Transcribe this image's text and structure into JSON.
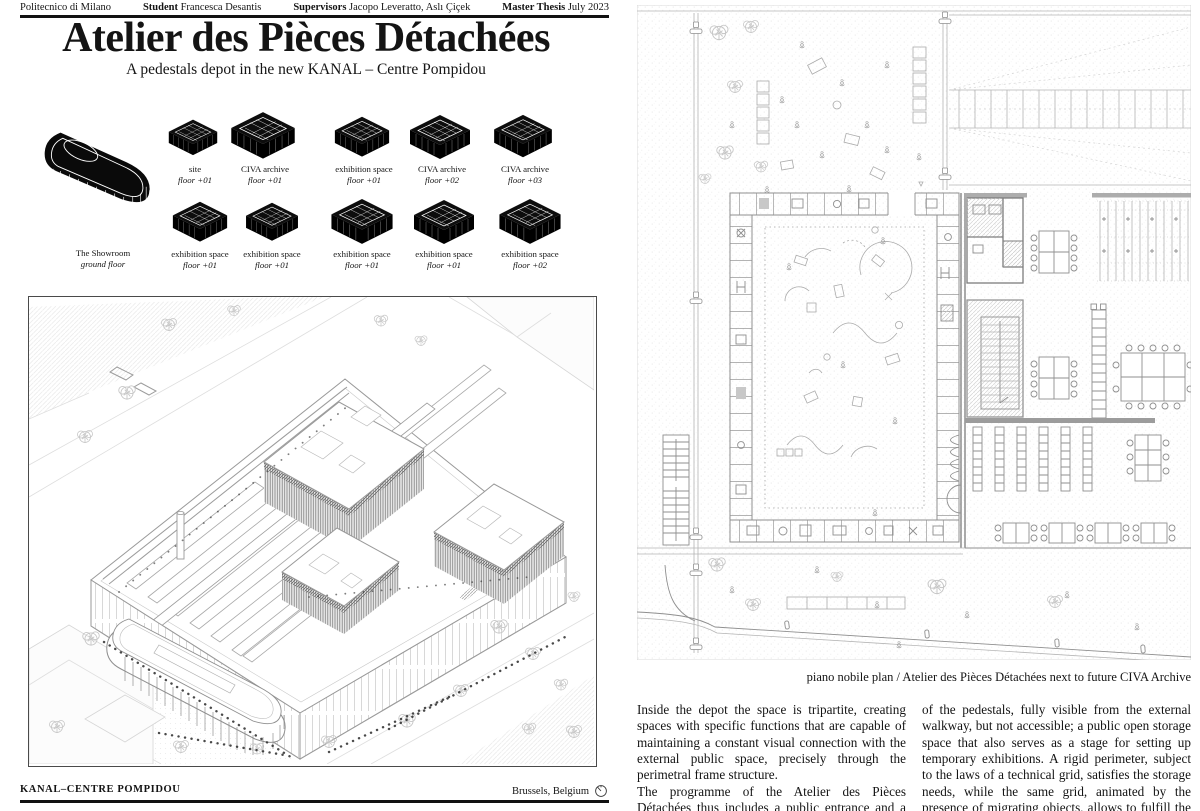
{
  "header": {
    "institution": "Politecnico di Milano",
    "student_label": "Student",
    "student_name": "Francesca Desantis",
    "supervisors_label": "Supervisors",
    "supervisors_names": "Jacopo Leveratto, Aslı Çiçek",
    "thesis_label": "Master Thesis",
    "thesis_date": "July 2023"
  },
  "masthead": {
    "title": "Atelier des Pièces Détachées",
    "subtitle": "A pedestals depot in the new KANAL – Centre Pompidou"
  },
  "diagrams": {
    "showroom": {
      "name": "The Showroom",
      "floor": "ground floor"
    },
    "row1": [
      {
        "name": "site",
        "floor": "floor +01"
      },
      {
        "name": "CIVA archive",
        "floor": "floor +01"
      },
      {
        "name": "exhibition space",
        "floor": "floor +01"
      },
      {
        "name": "CIVA archive",
        "floor": "floor +02"
      },
      {
        "name": "CIVA archive",
        "floor": "floor +03"
      }
    ],
    "row2": [
      {
        "name": "exhibition space",
        "floor": "floor +01"
      },
      {
        "name": "exhibition space",
        "floor": "floor +01"
      },
      {
        "name": "exhibition space",
        "floor": "floor +01"
      },
      {
        "name": "exhibition space",
        "floor": "floor +01"
      },
      {
        "name": "exhibition space",
        "floor": "floor +02"
      }
    ]
  },
  "plan": {
    "caption": "piano nobile plan / Atelier des Pièces Détachées next to future CIVA Archive"
  },
  "body": {
    "col1_p1": "Inside the depot the space is tripartite, creating spaces with specific functions that are capable of maintaining a constant visual connection with the external public space, precisely through the perimetral frame structure.",
    "col1_p2": "The programme of the Atelier des Pièces Détachées thus includes a public entrance and a bookshop space; a workshop space intended for the study and digital archiving",
    "col2_p1": "of the pedestals, fully visible from the external walkway, but not accessible; a public open storage space that also serves as a stage for setting up temporary exhibitions. A rigid perimeter, subject to the laws of a technical grid, satisfies the storage needs, while the same grid, animated by the presence of migrating objects, allows to fulfill the needs for flexibility of the central stage."
  },
  "footer": {
    "project": "KANAL–CENTRE POMPIDOU",
    "location": "Brussels, Belgium"
  },
  "colors": {
    "ink": "#141414",
    "line_light": "#c3c3c3",
    "line_mid": "#9a9a9a"
  }
}
